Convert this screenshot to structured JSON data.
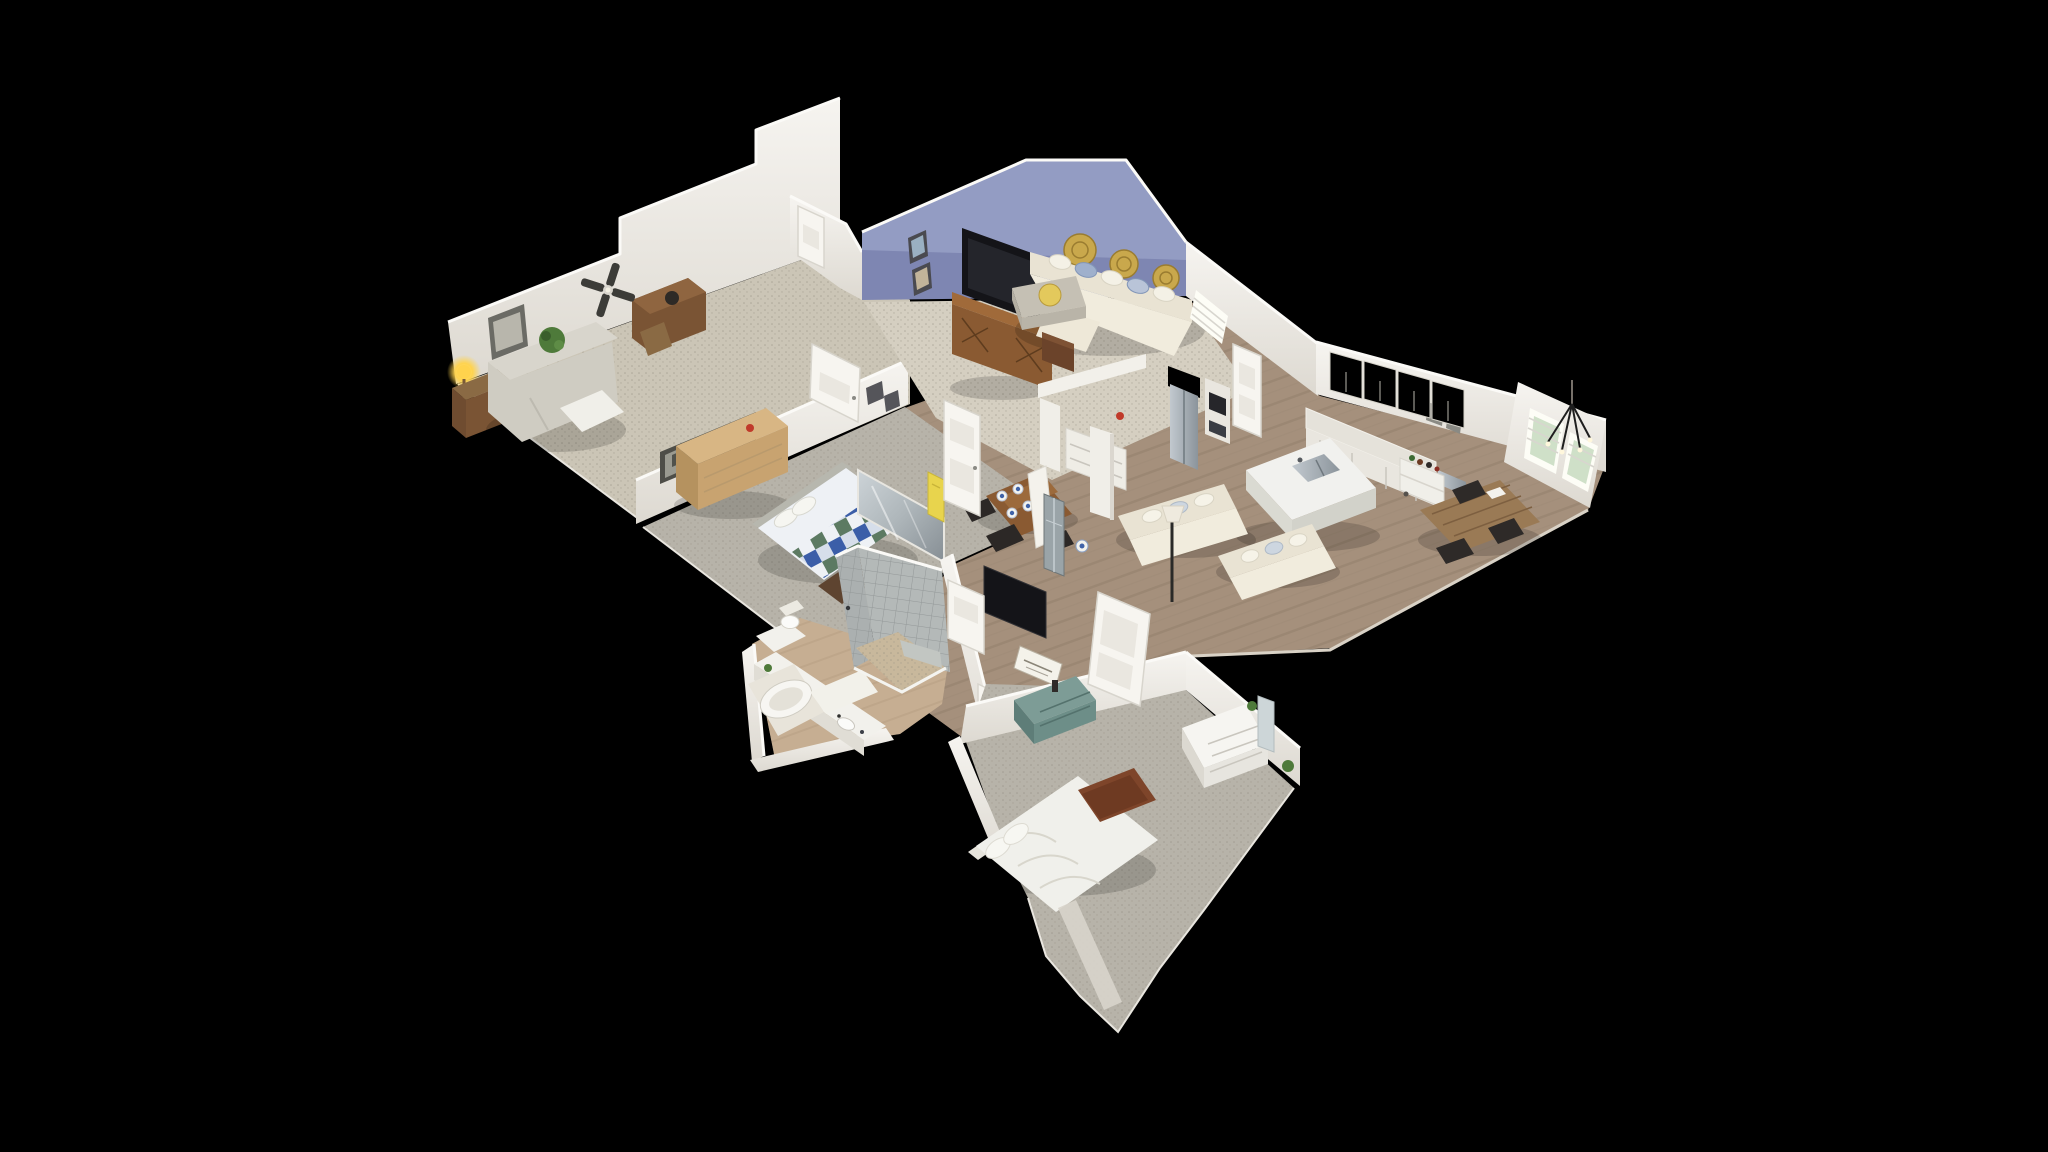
{
  "app": {
    "name": "3D Virtual Tour Viewer",
    "view_mode": "dollhouse",
    "background": "#000000"
  },
  "scene": {
    "type": "residential-interior-3d-scan-cutaway",
    "camera": "high-angle isometric orbit",
    "walls": "cut open from above, bright cut edges",
    "house_bounds_px": {
      "x": 448,
      "y": 96,
      "width": 1160,
      "height": 936
    }
  },
  "palette": {
    "background": "#000000",
    "wall_white": "#f3f1ec",
    "wall_shade": "#ddd9d1",
    "wall_cut": "#fbfaf7",
    "wall_blue": "#7e86b2",
    "wall_blue_light": "#9ba3c8",
    "carpet_cream": "#d5cfc1",
    "carpet_tan": "#cbc5b6",
    "carpet_gray": "#b7b3a9",
    "wood_floor": "#a5907c",
    "wood_floor_dark": "#93806c",
    "bath_floor": "#c6ae92",
    "tile_gray": "#abb0b0",
    "tile_gray_light": "#b4b9b8",
    "pebble": "#c8b89c",
    "sofa_cream": "#e9e3d3",
    "quilt_blue": "#3b5ea8",
    "quilt_green": "#5c7a62",
    "quilt_white": "#eef1f5",
    "teal_dresser": "#6d8e88",
    "wood_medium": "#8a5a32",
    "wood_dark": "#6b432a",
    "wood_rustic": "#9a7a55",
    "tv_black": "#141418",
    "gold": "#c9a84c",
    "lamp_glow": "#ffd34d",
    "plant_green": "#4e7a3a",
    "window_light": "#fdfdf6",
    "steel_light": "#c2c9cf",
    "steel_dark": "#8b949b",
    "banner_yellow": "#e8d44d"
  },
  "rooms": [
    {
      "id": "sitting-room",
      "label": "Sitting room",
      "floor": "carpet",
      "items": [
        "floor-lamp",
        "end-table",
        "loveseat",
        "potted-plant",
        "wall-art",
        "desk-with-sewing-machine",
        "ceiling-fan"
      ]
    },
    {
      "id": "living-room",
      "label": "Living room",
      "floor": "carpet",
      "items": [
        "wall-tv",
        "media-console",
        "sectional-sofa",
        "ottoman-with-tray",
        "gold-wall-plates",
        "picture-frames",
        "end-table",
        "entry-door"
      ]
    },
    {
      "id": "kitchen-great-room",
      "label": "Kitchen and great room",
      "floor": "wood",
      "items": [
        "refrigerator",
        "upper-cabinets",
        "wall-oven",
        "counter-run",
        "kitchen-island",
        "island-sink",
        "coffee-cart",
        "double-windows",
        "sofa-pair",
        "floor-lamp",
        "farmhouse-table",
        "metal-chairs",
        "pendant-light",
        "sideboard",
        "columns",
        "pantry-door"
      ]
    },
    {
      "id": "dining-nook",
      "label": "Dining nook",
      "floor": "wood",
      "items": [
        "dining-table",
        "blue-white-place-settings",
        "dark-chairs",
        "slipcover-chair",
        "china-cabinet"
      ]
    },
    {
      "id": "master-bedroom",
      "label": "Main bedroom",
      "floor": "carpet",
      "items": [
        "plaid-quilt-bed",
        "pillows",
        "foot-chest",
        "wood-dresser",
        "train-wall-art",
        "mirror-panel",
        "hall-door"
      ]
    },
    {
      "id": "master-bathroom",
      "label": "Main bathroom",
      "floor": "tile",
      "items": [
        "walk-in-tiled-shower",
        "pebble-shower-floor",
        "garden-tub",
        "double-vanity",
        "sinks",
        "toilet",
        "bath-mat"
      ]
    },
    {
      "id": "hallway",
      "label": "Hallway",
      "floor": "wood",
      "items": [
        "white-doors",
        "leaning-tv",
        "yellow-banner",
        "wall-frames",
        "red-extinguisher"
      ]
    },
    {
      "id": "guest-bedroom",
      "label": "Guest bedroom",
      "floor": "carpet",
      "items": [
        "white-bed",
        "leather-bench",
        "white-dresser",
        "mirror",
        "teal-dresser",
        "framed-sign",
        "open-door"
      ]
    }
  ]
}
